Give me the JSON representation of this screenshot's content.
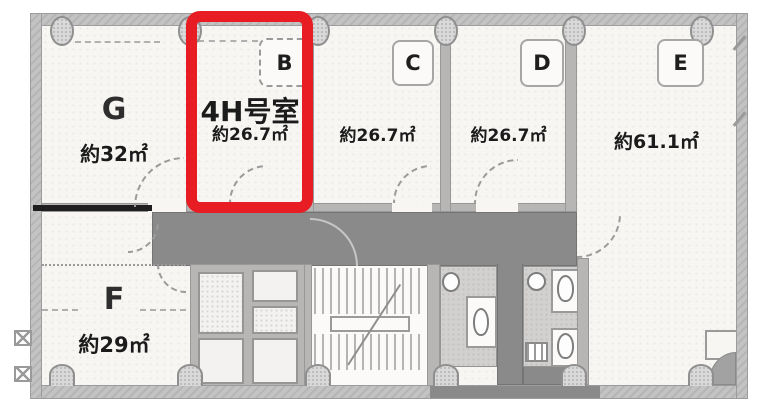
{
  "plan": {
    "rooms": {
      "g": {
        "letter": "G",
        "area": "約32㎡"
      },
      "b": {
        "letter": "B",
        "unit_name": "4H号室",
        "area": "約26.7㎡"
      },
      "c": {
        "letter": "C",
        "area": "約26.7㎡"
      },
      "d": {
        "letter": "D",
        "area": "約26.7㎡"
      },
      "e": {
        "letter": "E",
        "area": "約61.1㎡"
      },
      "f": {
        "letter": "F",
        "area": "約29㎡"
      }
    },
    "colors": {
      "highlight": "#e71d23",
      "corridor": "#8a8a8a",
      "wall": "#c3c3c3",
      "floor": "#f7f6f3",
      "accent-line": "#1f1f1f"
    }
  }
}
